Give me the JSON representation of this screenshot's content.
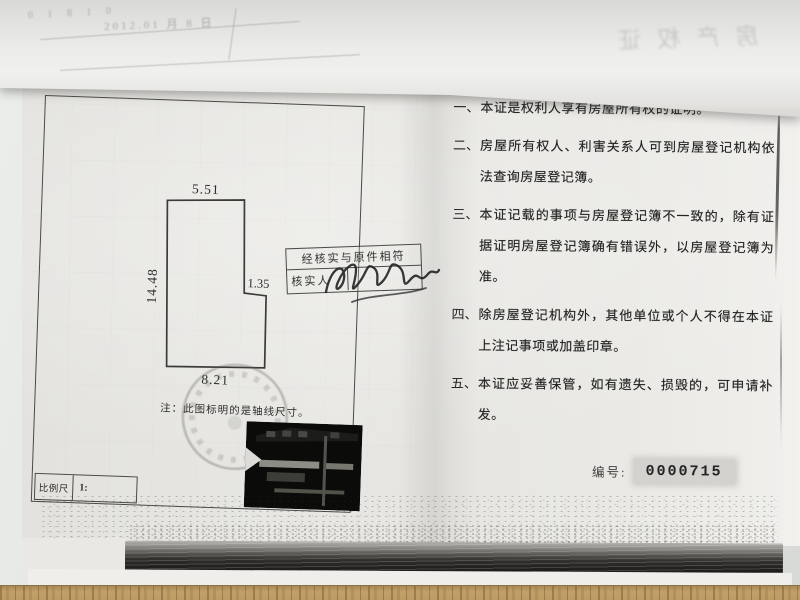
{
  "right_page": {
    "notes": [
      {
        "num": "一、",
        "text": "本证是权利人享有房屋所有权的证明。"
      },
      {
        "num": "二、",
        "text": "房屋所有权人、利害关系人可到房屋登记机构依法查询房屋登记簿。"
      },
      {
        "num": "三、",
        "text": "本证记载的事项与房屋登记簿不一致的，除有证据证明房屋登记簿确有错误外，以房屋登记簿为准。"
      },
      {
        "num": "四、",
        "text": "除房屋登记机构外，其他单位或个人不得在本证上注记事项或加盖印章。"
      },
      {
        "num": "五、",
        "text": "本证应妥善保管，如有遗失、损毁的，可申请补发。"
      }
    ],
    "serial_label": "编号:",
    "serial_value": "0000715"
  },
  "floor_plan": {
    "dim_top": "5.51",
    "dim_left": "14.48",
    "dim_step": "1.35",
    "dim_bottom": "8.21",
    "note": "注：此图标明的是轴线尺寸。",
    "scale_label": "比例尺",
    "scale_value": "1:"
  },
  "verification_stamp": {
    "line1": "经核实与原件相符",
    "line2": "核实人"
  },
  "ghost": {
    "date_line": "2012.01 月 8 日",
    "digits": "0 1 8 1 0",
    "mirrored_chars": "房产权证"
  },
  "colors": {
    "paper": "#e8e7e3",
    "ink": "#232321",
    "frame_line": "#4a4a46",
    "edge_band_dark": "#232220",
    "wood": "#c2a068",
    "serial_highlight": "#d3d2ce"
  }
}
